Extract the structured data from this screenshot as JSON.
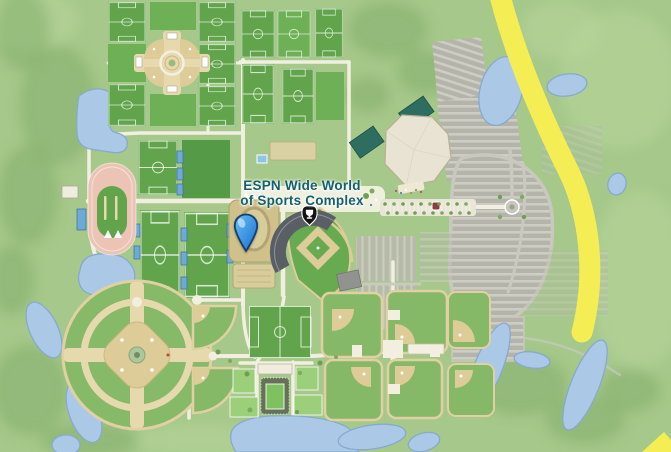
{
  "map": {
    "location_label": {
      "line1": "ESPN Wide World",
      "line2": "of Sports Complex"
    },
    "marker": "selected-location-pin",
    "venue_badge": "sports-venue-icon",
    "features": [
      "soccer-field-grid-northwest",
      "softball-pinwheel-complex",
      "soccer-field-grid-north",
      "track-and-field-stadium",
      "soccer-field-grid-west",
      "field-house",
      "baseball-stadium",
      "arena",
      "parking-lots",
      "highway",
      "baseball-quadraplex",
      "baseball-cloverleaf",
      "tennis-complex",
      "ponds"
    ]
  },
  "colors": {
    "bg": "#a6c88a",
    "field": "#61a44b",
    "pond": "#abc9e6",
    "pond-edge": "#86aacf",
    "road": "#f2efe1",
    "parking": "#b4b4ab",
    "sand": "#ddcb98",
    "highway": "#f4ee54",
    "track": "#ecc4b6",
    "arena-roof": "#e9e3d3",
    "arena-wing": "#2e6e60",
    "stand-gray": "#5a5f66",
    "label-teal": "#15606d",
    "pin-light": "#66c0f2",
    "pin-dark": "#1a6ed1",
    "badge-black": "#141414"
  }
}
